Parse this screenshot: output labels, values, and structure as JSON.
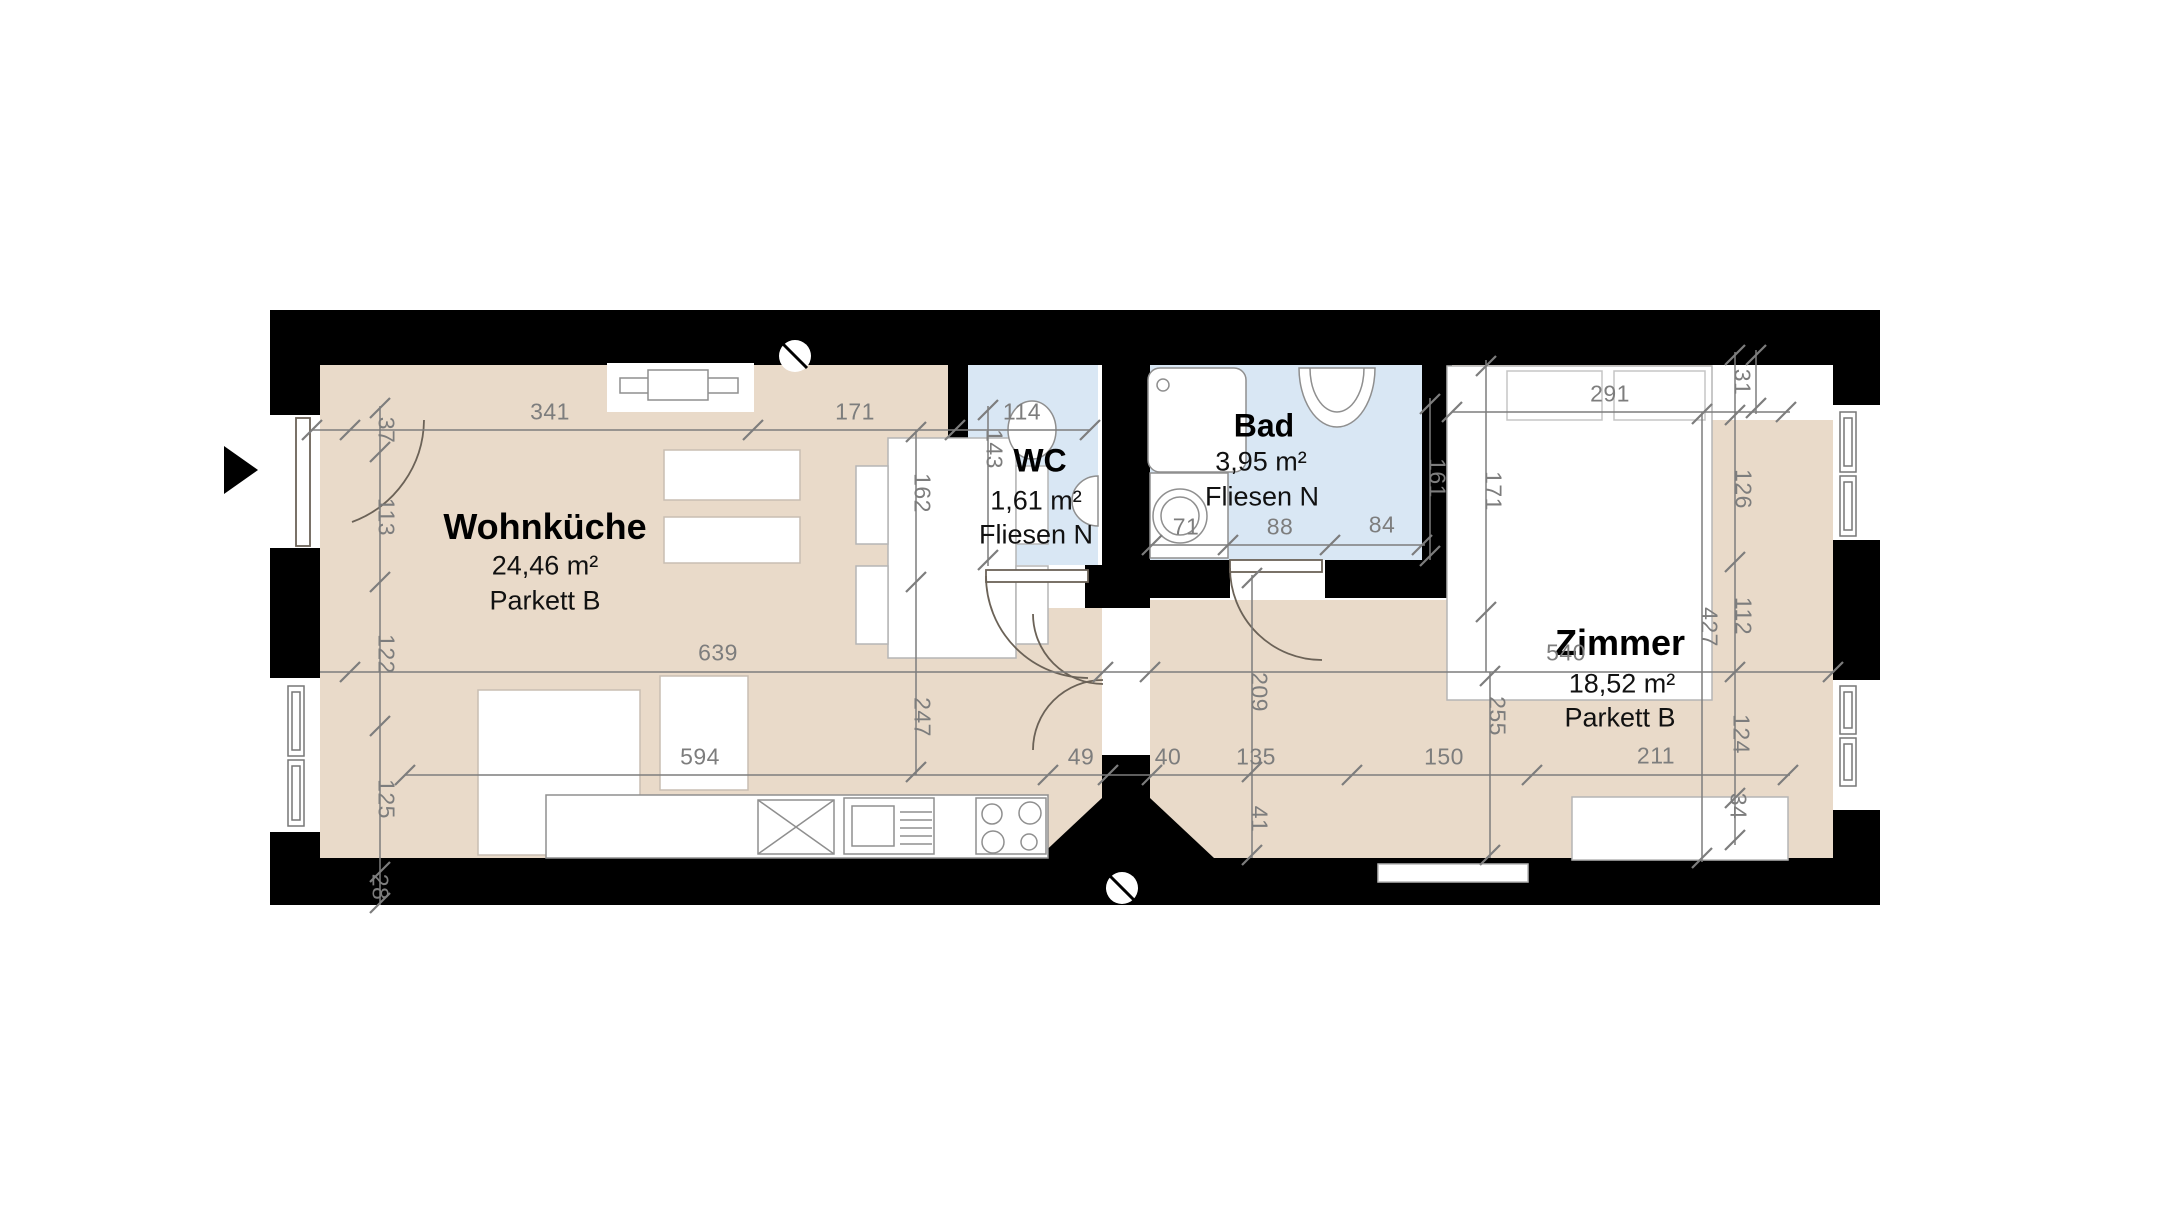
{
  "plan": {
    "rooms": {
      "wohnkueche": {
        "name": "Wohnküche",
        "area": "24,46 m²",
        "floor": "Parkett B"
      },
      "wc": {
        "name": "WC",
        "area": "1,61 m²",
        "floor": "Fliesen N"
      },
      "bad": {
        "name": "Bad",
        "area": "3,95 m²",
        "floor": "Fliesen N"
      },
      "zimmer": {
        "name": "Zimmer",
        "area": "18,52 m²",
        "floor": "Parkett B"
      }
    },
    "dims": {
      "t341": "341",
      "t171": "171",
      "t114": "114",
      "t291": "291",
      "l37": "37",
      "l113": "113",
      "l122": "122",
      "l125": "125",
      "l28": "28",
      "r31": "31",
      "r126": "126",
      "r112": "112",
      "r124": "124",
      "r34": "34",
      "v143": "143",
      "v162": "162",
      "v247": "247",
      "v161": "161",
      "v171": "171",
      "v209": "209",
      "v255": "255",
      "v427": "427",
      "v41": "41",
      "h639": "639",
      "h540": "540",
      "h594": "594",
      "h49": "49",
      "h40": "40",
      "h135": "135",
      "h150": "150",
      "h211": "211",
      "b71": "71",
      "b88": "88",
      "b84": "84"
    },
    "colors": {
      "wall": "#000000",
      "parkett": "#e9dac9",
      "fliesen": "#d9e7f4",
      "dim": "#7d7d7d",
      "furn": "#8f8f8f",
      "arc": "#6b6257",
      "bg": "#ffffff"
    }
  }
}
